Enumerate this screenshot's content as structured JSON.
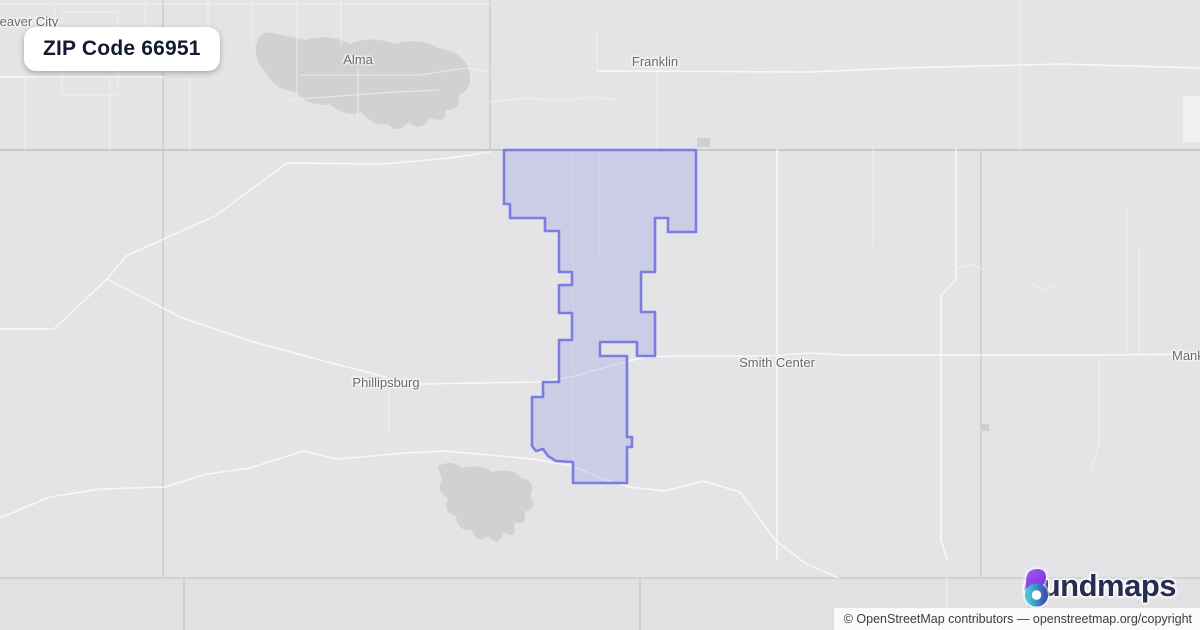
{
  "title_card": {
    "label": "ZIP Code 66951"
  },
  "logo": {
    "brand": "boundmaps",
    "word_after_icon": "oundmaps",
    "icon_colors": {
      "petal_from": "#a855f0",
      "petal_to": "#7433df",
      "ring_from": "#3fc7d8",
      "ring_to": "#3b55b4"
    }
  },
  "attribution": {
    "text": "© OpenStreetMap contributors — openstreetmap.org/copyright"
  },
  "map": {
    "background": "#e4e4e6",
    "boundary_color": "#7b7de0",
    "boundary_fill": "rgba(124,128,226,.24)",
    "city_labels": [
      {
        "slug": "beaver-city",
        "name": "Beaver City",
        "x": -9,
        "y": 14,
        "anchor": "start"
      },
      {
        "slug": "alma",
        "name": "Alma",
        "x": 358,
        "y": 52,
        "anchor": "middle"
      },
      {
        "slug": "franklin",
        "name": "Franklin",
        "x": 655,
        "y": 54,
        "anchor": "middle"
      },
      {
        "slug": "phillipsburg",
        "name": "Phillipsburg",
        "x": 386,
        "y": 375,
        "anchor": "middle"
      },
      {
        "slug": "smith-center",
        "name": "Smith Center",
        "x": 777,
        "y": 355,
        "anchor": "middle"
      },
      {
        "slug": "mankato",
        "name": "Mankato",
        "x": 1172,
        "y": 348,
        "anchor": "start"
      }
    ],
    "vectors": [
      {
        "name": "county-shade-band",
        "class": "band",
        "d": "M0,578 L1200,578 L1200,630 L0,630 Z"
      },
      {
        "name": "lake-harlan",
        "class": "lake",
        "d": "M258,40 Q262,29 276,34 L306,40 Q330,33 350,44 Q370,35 395,44 Q420,37 438,48 Q463,52 468,68 Q475,88 458,96 Q463,110 445,110 Q449,124 430,118 Q421,133 408,122 Q398,135 388,124 Q372,127 362,112 Q345,118 330,104 Q310,108 295,92 Q275,90 265,72 Q251,56 258,40 Z"
      },
      {
        "name": "lake-kirwin",
        "class": "lake",
        "d": "M438,466 Q452,459 462,468 Q480,463 492,472 Q512,467 522,478 Q537,482 530,496 Q539,508 524,512 Q529,526 514,522 Q517,541 504,532 Q498,549 488,536 Q478,545 472,530 Q457,532 456,516 Q443,514 448,498 Q435,492 442,480 Z"
      },
      {
        "name": "map-patch-topright",
        "class": "patch",
        "d": "M1183,96 L1200,96 L1200,142 L1183,142 Z"
      },
      {
        "name": "state-line",
        "class": "admin-strong",
        "d": "M0,150 L1200,150"
      },
      {
        "name": "county-line-south",
        "class": "admin",
        "d": "M0,578 L1200,578"
      },
      {
        "name": "county-line-west",
        "class": "admin",
        "d": "M163,0 L163,578"
      },
      {
        "name": "county-line-north",
        "class": "admin",
        "d": "M490,0 L490,150"
      },
      {
        "name": "county-line-east",
        "class": "admin",
        "d": "M981,150 L981,578"
      },
      {
        "name": "county-line-sw",
        "class": "admin",
        "d": "M184,578 L184,630"
      },
      {
        "name": "county-line-sc",
        "class": "admin",
        "d": "M640,578 L640,630"
      },
      {
        "name": "county-line-se",
        "class": "admin",
        "d": "M1029,578 L1029,630"
      },
      {
        "name": "road-grid-top-h1",
        "class": "road-faint",
        "d": "M0,4 L490,4"
      },
      {
        "name": "road-grid-top-h2",
        "class": "road",
        "d": "M0,77 L163,77"
      },
      {
        "name": "road-grid-top-v1",
        "class": "road-faint",
        "d": "M55,4 L55,77"
      },
      {
        "name": "road-grid-top-v2",
        "class": "road-faint",
        "d": "M25,77 L25,150"
      },
      {
        "name": "road-grid-top-v3",
        "class": "road-faint",
        "d": "M110,77 L110,150"
      },
      {
        "name": "road-grid-top-v4",
        "class": "road-faint",
        "d": "M145,4 L145,60"
      },
      {
        "name": "road-grid-top-v5",
        "class": "road-faint",
        "d": "M190,77 L190,150"
      },
      {
        "name": "road-grid-top-v6",
        "class": "road-faint",
        "d": "M208,0 L208,40"
      },
      {
        "name": "road-grid-top-v7",
        "class": "road-faint",
        "d": "M252,0 L252,45"
      },
      {
        "name": "road-grid-top-v8",
        "class": "road-faint",
        "d": "M297,0 L297,95"
      },
      {
        "name": "road-grid-top-v9",
        "class": "road-faint",
        "d": "M341,0 L341,45"
      },
      {
        "name": "road-beaver-block1",
        "class": "road-faint",
        "d": "M62,12 L118,12 L118,95 L62,95 Z"
      },
      {
        "name": "road-beaver-block2",
        "class": "road-faint",
        "d": "M118,30 L155,30 L155,70 L118,70"
      },
      {
        "name": "road-lake-north",
        "class": "road-faint",
        "d": "M285,100 L340,96 L395,92 L440,90"
      },
      {
        "name": "road-alma-v",
        "class": "road-faint",
        "d": "M358,68 L358,122"
      },
      {
        "name": "road-alma-h",
        "class": "road-faint",
        "d": "M300,75 L420,75 L465,68 L490,72"
      },
      {
        "name": "road-franklin-v1",
        "class": "road-faint",
        "d": "M597,30 L597,71"
      },
      {
        "name": "road-franklin-v2",
        "class": "road-faint",
        "d": "M657,65 L657,150"
      },
      {
        "name": "road-franklin-h",
        "class": "road",
        "d": "M598,71 L810,72 L900,68 L1060,64 L1200,68"
      },
      {
        "name": "road-river-wiggle",
        "class": "road-faint",
        "d": "M490,102 L530,98 L560,101 L590,97 L620,100"
      },
      {
        "name": "road-top-v-east",
        "class": "road-faint",
        "d": "M1020,0 L1020,150"
      },
      {
        "name": "road-nw-diagonal",
        "class": "road",
        "d": "M0,329 L54,329 L107,279 L126,256 L215,216 L287,163 L383,164 L450,158 L490,152"
      },
      {
        "name": "road-to-phillipsburg",
        "class": "road",
        "d": "M107,279 L180,317 L250,341 L320,360 L386,377"
      },
      {
        "name": "road-us36-west",
        "class": "road",
        "d": "M420,384 L540,382 L575,376 L610,366 L645,357 L680,356"
      },
      {
        "name": "road-us36-east",
        "class": "road",
        "d": "M680,356 L770,356 L810,353 L843,355 L981,355 L1100,355 L1200,354"
      },
      {
        "name": "road-phillipsburg-v",
        "class": "road-faint",
        "d": "M389,390 L389,432"
      },
      {
        "name": "road-south-winding",
        "class": "road",
        "d": "M0,518 L50,497 L100,489 L165,487 L207,474 L250,468 L303,451 L337,459 L406,453 L444,451 L500,456 L532,459"
      },
      {
        "name": "road-south-winding-east",
        "class": "road",
        "d": "M532,459 L573,466 L600,478 L629,487 L665,491 L703,481 L740,492 L776,541 L805,563 L838,578"
      },
      {
        "name": "road-zip-v1",
        "class": "road-faint",
        "d": "M573,150 L573,480"
      },
      {
        "name": "road-zip-v2",
        "class": "road-faint",
        "d": "M599,150 L599,260"
      },
      {
        "name": "road-smith-v",
        "class": "road",
        "d": "M777,150 L777,560"
      },
      {
        "name": "road-east-v1",
        "class": "road-faint",
        "d": "M873,150 L873,245"
      },
      {
        "name": "road-east-v2",
        "class": "road",
        "d": "M956,150 L956,280 L941,295 L941,540 L947,560"
      },
      {
        "name": "road-east-v2-south",
        "class": "road-faint",
        "d": "M947,578 L947,630"
      },
      {
        "name": "road-east-v3",
        "class": "road-faint",
        "d": "M1127,210 L1127,355"
      },
      {
        "name": "road-east-v4",
        "class": "road-faint",
        "d": "M1139,250 L1139,354"
      },
      {
        "name": "road-east-v5",
        "class": "road-faint",
        "d": "M1099,355 L1099,445 L1090,470"
      },
      {
        "name": "creek-east-1",
        "class": "road-faint",
        "d": "M950,262 L960,268 L972,264 L985,270"
      },
      {
        "name": "creek-east-2",
        "class": "road-faint",
        "d": "M1030,283 L1042,290 L1055,286"
      },
      {
        "name": "town-square-1",
        "class": "townsq",
        "d": "M697,138 L710,138 L710,147 L697,147 Z"
      },
      {
        "name": "town-square-2",
        "class": "townsq",
        "d": "M981,424 L989,424 L989,431 L981,431 Z"
      },
      {
        "name": "zip-boundary",
        "class": "boundary",
        "interactable": true,
        "d": "M504,150 L504,204 L510,204 L510,218 L545,218 L545,231 L559,231 L559,272 L572,272 L572,285 L559,285 L559,313 L572,313 L572,340 L559,340 L559,382 L543,382 L543,397 L532,397 L532,446 L536,451 L543,449 L548,456 L556,461 L573,462 L573,483 L627,483 L627,447 L632,447 L632,437 L627,437 L627,356 L600,356 L600,342 L637,342 L637,356 L655,356 L655,312 L641,312 L641,272 L655,272 L655,218 L668,218 L668,232 L696,232 L696,150 Z"
      }
    ]
  }
}
